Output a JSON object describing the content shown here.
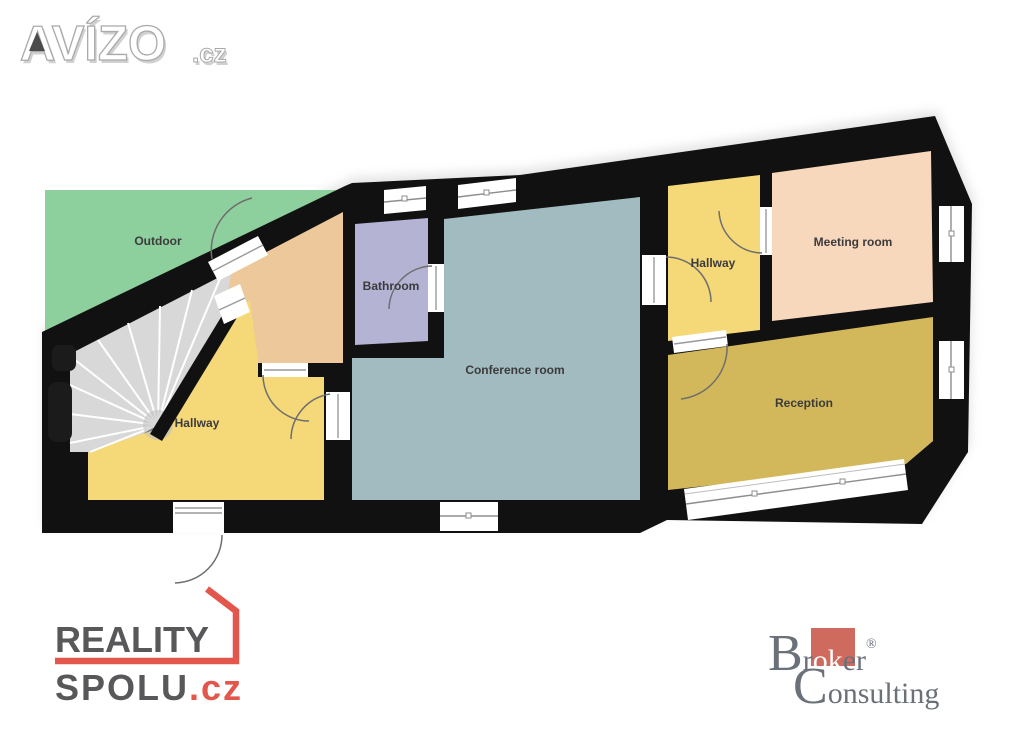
{
  "avizo_watermark": {
    "brand": "AVÍZO",
    "tld": ".cz"
  },
  "floor_plan": {
    "labels": {
      "outdoor": "Outdoor",
      "hallway_left": "Hallway",
      "bathroom": "Bathroom",
      "conference": "Conference room",
      "hallway_right": "Hallway",
      "meeting": "Meeting room",
      "reception": "Reception"
    },
    "colors": {
      "wall": "#111111",
      "outdoor": "#8ecf9e",
      "hallway": "#f5d878",
      "bathroom": "#b5b3d4",
      "conference": "#a1bbc1",
      "meeting": "#f7d8bd",
      "reception": "#d3b85b",
      "stairs": "#d8d8d8",
      "landing": "#ecc89b",
      "door_arc": "#6e6e6e"
    }
  },
  "reality_spolu_logo": {
    "word1": "REALITY",
    "word2": "SPOLU",
    "tld": ".cz",
    "text_color": "#58585a",
    "accent_color": "#e2564b"
  },
  "broker_logo": {
    "cap1": "B",
    "seg1": "r",
    "seg2": "ok",
    "seg3": "er",
    "registered": "®",
    "cap2": "C",
    "seg4": "onsulting",
    "text_color": "#6b7178",
    "accent_color": "#cf6a5e"
  }
}
